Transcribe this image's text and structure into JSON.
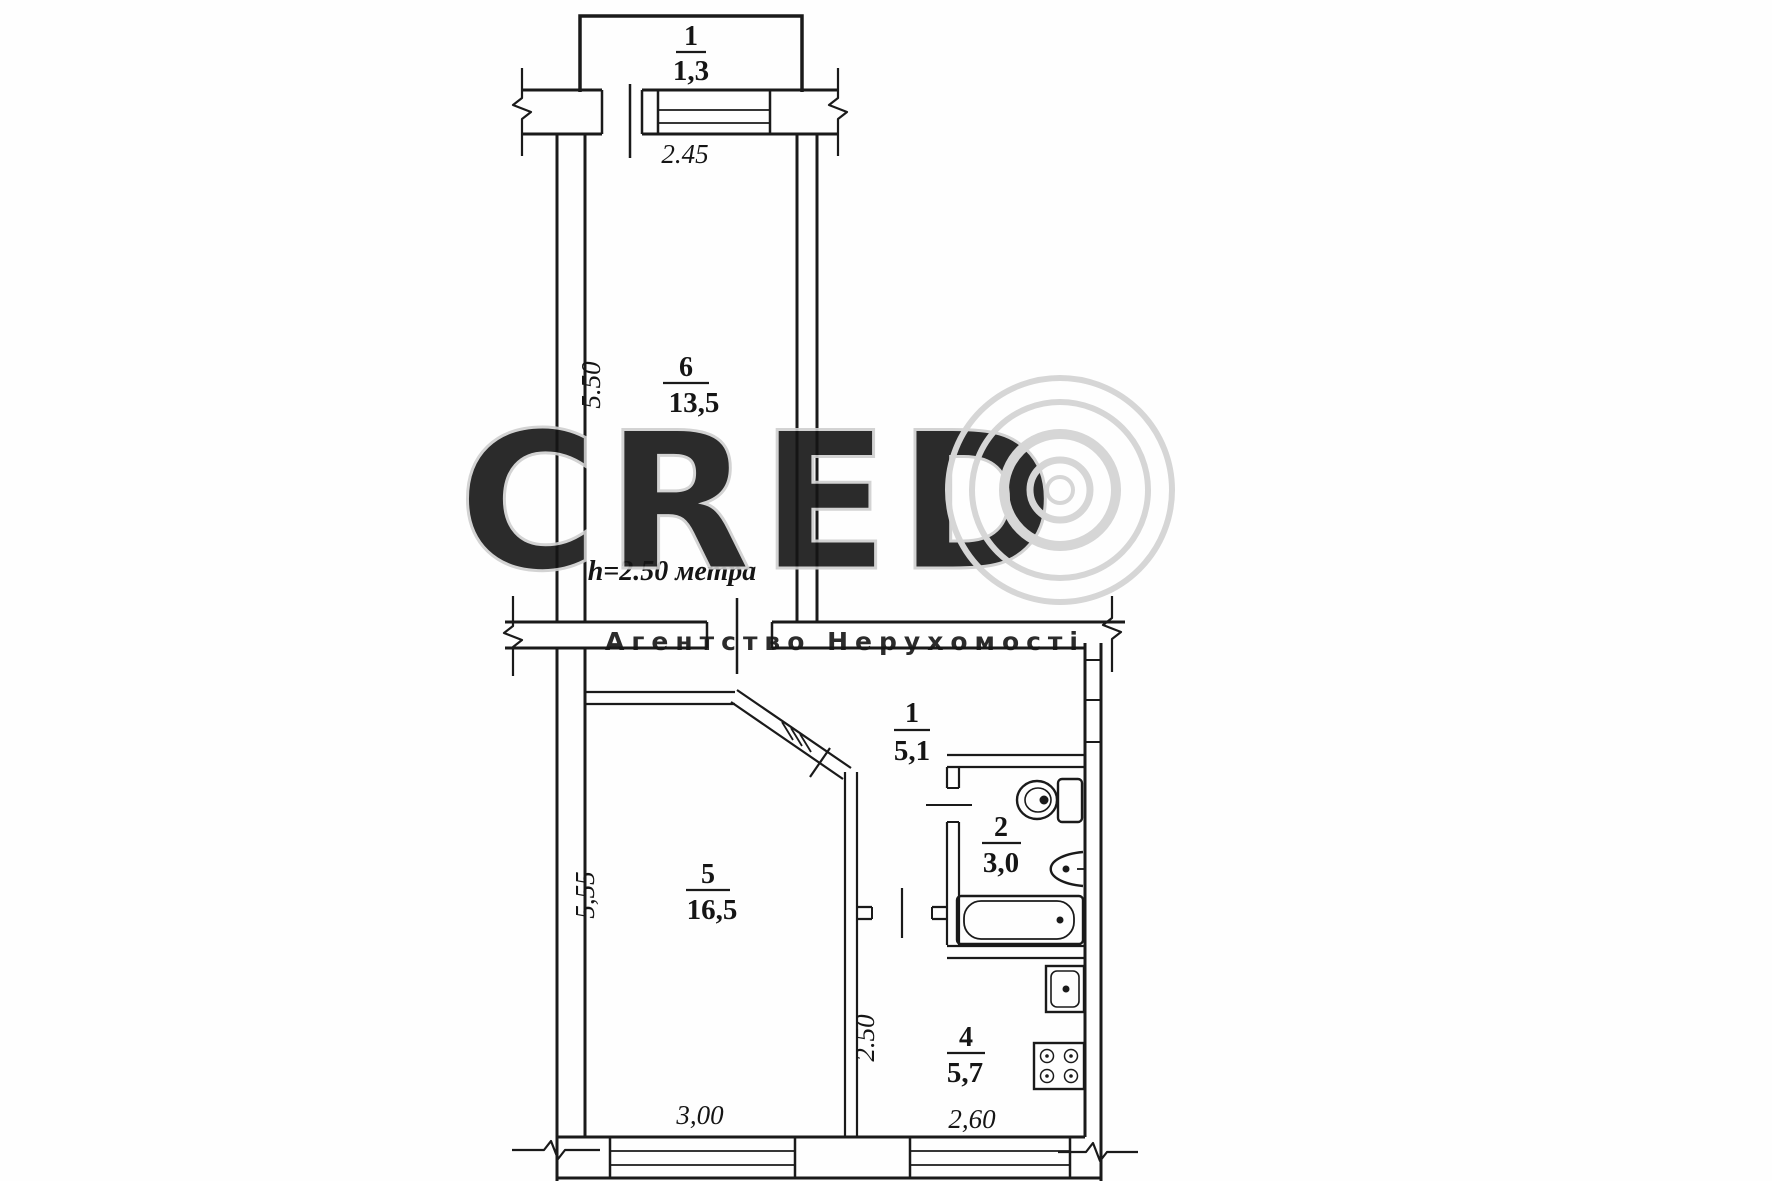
{
  "watermark": {
    "brand": "CRED",
    "subtitle": "Агентство Нерухомості",
    "color": "#cfcfcf"
  },
  "plan": {
    "height_note": "h=2.50 метра",
    "ink": "#1a1a1a",
    "rooms": {
      "balcony": {
        "number": "1",
        "area": "1,3"
      },
      "living": {
        "number": "6",
        "area": "13,5"
      },
      "hall": {
        "number": "1",
        "area": "5,1"
      },
      "bathroom": {
        "number": "2",
        "area": "3,0"
      },
      "bedroom": {
        "number": "5",
        "area": "16,5"
      },
      "kitchen": {
        "number": "4",
        "area": "5,7"
      }
    },
    "dims": {
      "balcony_width": "2.45",
      "living_depth": "5.50",
      "bedroom_depth": "5,55",
      "bedroom_width": "3,00",
      "kitchen_depth": "2.50",
      "kitchen_width": "2,60"
    }
  }
}
